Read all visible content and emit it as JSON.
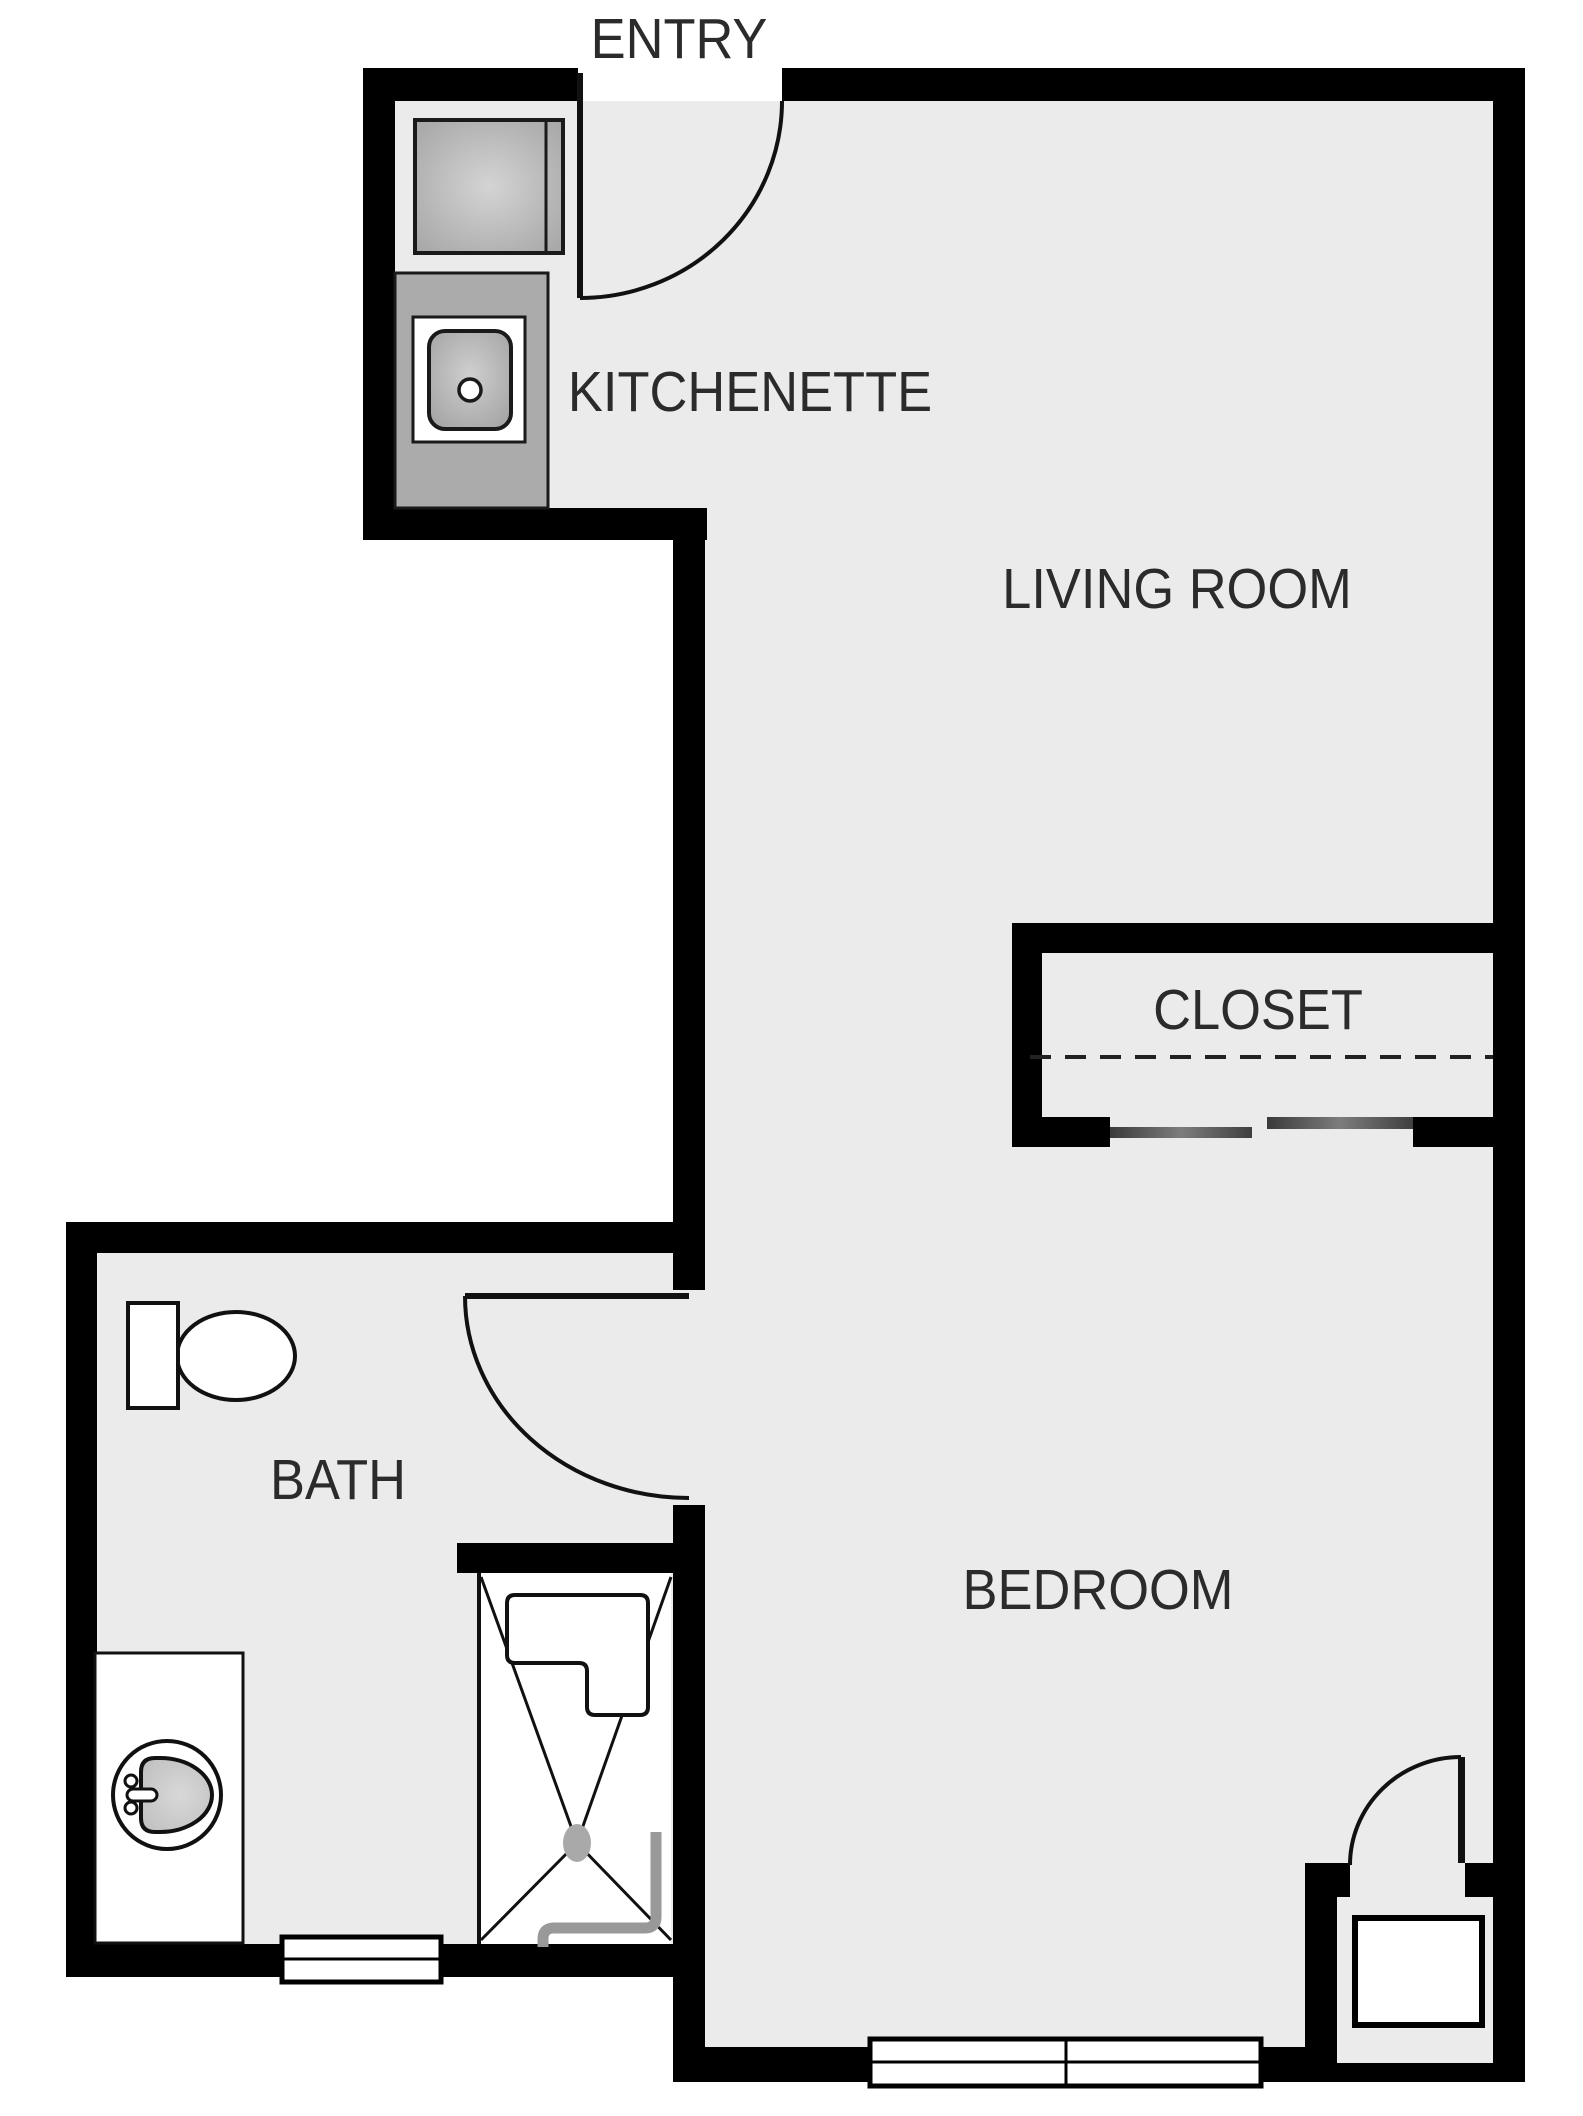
{
  "title": "Studio apartment floor plan",
  "rooms": [
    {
      "id": "entry",
      "label": "ENTRY"
    },
    {
      "id": "kitchenette",
      "label": "KITCHENETTE"
    },
    {
      "id": "living-room",
      "label": "LIVING ROOM"
    },
    {
      "id": "closet",
      "label": "CLOSET"
    },
    {
      "id": "bath",
      "label": "BATH"
    },
    {
      "id": "bedroom",
      "label": "BEDROOM"
    }
  ],
  "fixtures": [
    "refrigerator",
    "kitchenette-counter",
    "kitchen-sink",
    "entry-door",
    "closet-sliding-doors",
    "closet-rod",
    "toilet",
    "bath-door",
    "vanity-counter",
    "bathroom-sink",
    "shower",
    "shower-bench",
    "shower-pipe",
    "bath-window",
    "bedroom-window",
    "bedroom-door",
    "alcove-unit"
  ],
  "colors": {
    "background": "#ffffff",
    "floor": "#ebebeb",
    "wall": "#000000",
    "line": "#111111",
    "text": "#2b2b2b",
    "counter_gray": "#ababab",
    "appliance_gray": "#bdbdbd",
    "slider_gray": "#4d4d4d",
    "pipe_gray": "#999999",
    "valve_gray": "#a9a9a9"
  }
}
